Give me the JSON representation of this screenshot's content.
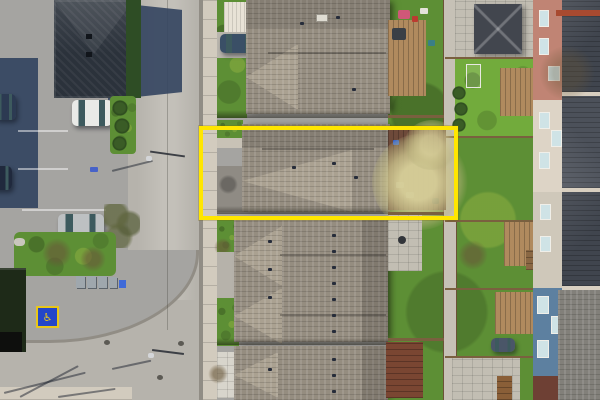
{
  "scene": {
    "kind": "aerial-drone-photo",
    "subject": "top-down view of a residential street; one townhouse lot highlighted with a yellow outline"
  },
  "annotation": {
    "name": "property-lot-outline",
    "color": "#ffe600"
  },
  "markings": {
    "accessible_parking_symbol": "♿"
  },
  "palette": {
    "lot": "#a5a4a1",
    "road": "#b6b3ac",
    "road-light": "#c3c0b9",
    "sidewalk": "#d2cbbe",
    "curb": "#918d85",
    "building-roof": "#2b323b",
    "shadow-navy": "#33445f",
    "shingle": "#958d80",
    "shingle-light": "#aaa191",
    "grass": "#5d8f35",
    "grass-bright": "#72ab3c",
    "stone": "#c2beb3",
    "fence": "#7a603f",
    "lane": "#c6c1b6",
    "deck-wood": "#b08a5e",
    "subject-deck": "#6e4a3a",
    "shed-rust": "#7a4632",
    "brick-pink": "#c08474",
    "cream-siding": "#ddd4c6",
    "cream-siding2": "#cfc8ba",
    "blue-siding": "#5d80a0",
    "dark-roof": "#40454e",
    "dark-roof2": "#4c515a",
    "gray-roof": "#82807a",
    "dark-brick": "#6e4034",
    "car-white": "#e9eae7",
    "car-silver": "#bdc0c2",
    "car-dark": "#2c3a52",
    "van-blue": "#3a4f66",
    "glass": "#3d5a5e",
    "dumpster": "#1e2a18",
    "hp-blue": "#2346c8",
    "hp-yellow": "#e8c619",
    "outline": "#ffe600"
  }
}
